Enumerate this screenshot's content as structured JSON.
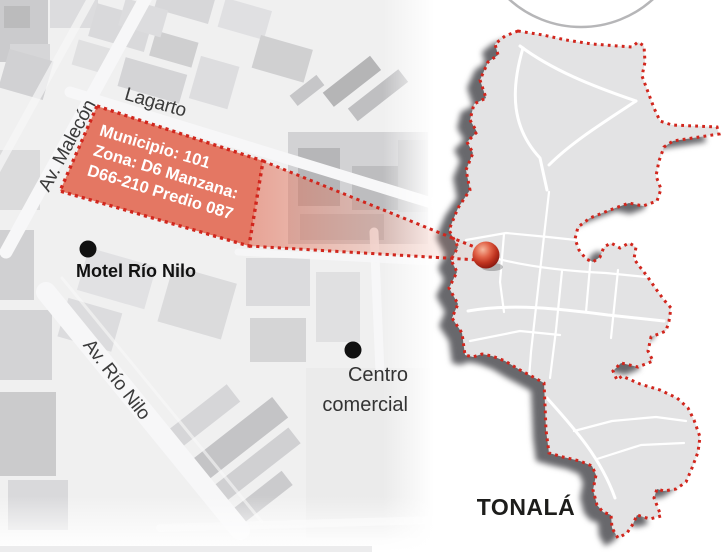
{
  "detail_map": {
    "street_labels": {
      "malecon": "Av. Malecón",
      "lagarto": "Lagarto",
      "rio_nilo": "Av. Río Nilo"
    },
    "parcel": {
      "line1": "Municipio: 101",
      "line2": "Zona: D6 Manzana:",
      "line3": "D66-210 Predio 087"
    },
    "pois": {
      "motel": "Motel Río Nilo",
      "centro_line1": "Centro",
      "centro_line2": "comercial"
    }
  },
  "overview_map": {
    "municipality": "TONALÁ"
  },
  "colors": {
    "parcel_fill": "#e26953",
    "dotted_red": "#d1261d",
    "map_fill": "#e3e3e4",
    "satellite_base": "#ededee",
    "label_dark": "#1d1d1b",
    "street_label": "#3a3a3a",
    "ball_red": "#c23420"
  }
}
